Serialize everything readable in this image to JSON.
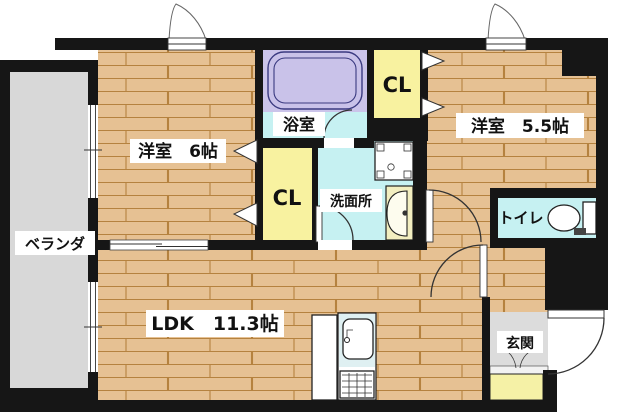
{
  "plan": {
    "type": "apartment-floor-plan",
    "labels": {
      "bedroom6": "洋室　6帖",
      "bedroom55": "洋室　5.5帖",
      "ldk": "LDK　11.3帖",
      "bath": "浴室",
      "washroom": "洗面所",
      "toilet": "トイレ",
      "entrance": "玄関",
      "veranda": "ベランダ",
      "closet_upper": "CL",
      "closet_lower": "CL"
    },
    "colors": {
      "wall": "#161616",
      "wood_floor": "#E6C193",
      "wood_line": "#B5823F",
      "water_room": "#C6F1F2",
      "bath_lavender": "#CBC4EA",
      "closet_yellow": "#F8F2A0",
      "veranda_gray": "#D8D8D8",
      "entrance_gray": "#DCDCDC",
      "shoebox_yellow": "#F5F1A6",
      "kitchen_counter": "#DFF0F2",
      "vanity_counter": "#F2EEC0"
    }
  }
}
